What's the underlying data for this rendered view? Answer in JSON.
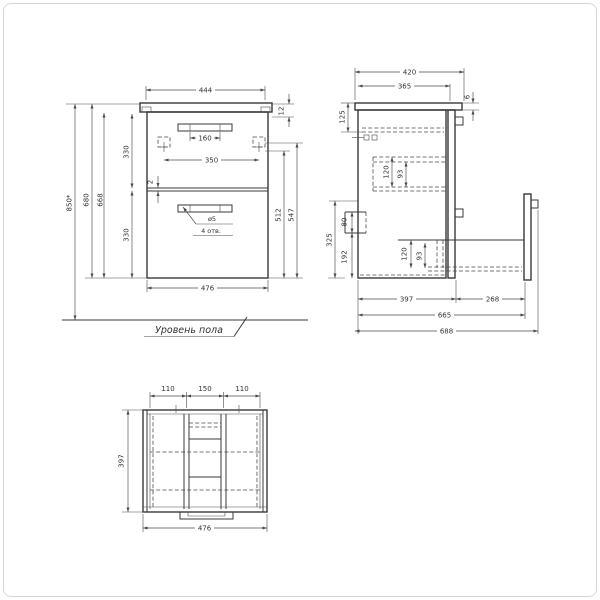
{
  "annotations": {
    "floor_label": "Уровень пола",
    "holes_diameter": "ø5",
    "holes_count": "4 отв."
  },
  "front_view": {
    "dim_top_width": "444",
    "dim_handle": "160",
    "dim_hole_spacing": "350",
    "dim_offset_top": "12",
    "dim_height_overall": "850*",
    "dim_height_680": "680",
    "dim_height_668": "668",
    "dim_drawer_top": "330",
    "dim_gap": "2",
    "dim_drawer_bottom": "330",
    "dim_512": "512",
    "dim_547": "547",
    "dim_bottom_width": "476"
  },
  "side_view": {
    "dim_depth_overall": "420",
    "dim_depth_body": "365",
    "dim_back_gap": "6",
    "dim_top_inset": "125",
    "dim_slide_upper_h": "120",
    "dim_slide_upper_inner": "93",
    "dim_cutout": "80",
    "dim_zone": "325",
    "dim_from_bottom": "192",
    "dim_slide_lower_h": "120",
    "dim_slide_lower_inner": "93",
    "dim_body_depth": "397",
    "dim_rail_offset": "268",
    "dim_665": "665",
    "dim_688": "688"
  },
  "top_view": {
    "dim_section_left": "110",
    "dim_section_center": "150",
    "dim_section_right": "110",
    "dim_depth": "397",
    "dim_width": "476"
  }
}
